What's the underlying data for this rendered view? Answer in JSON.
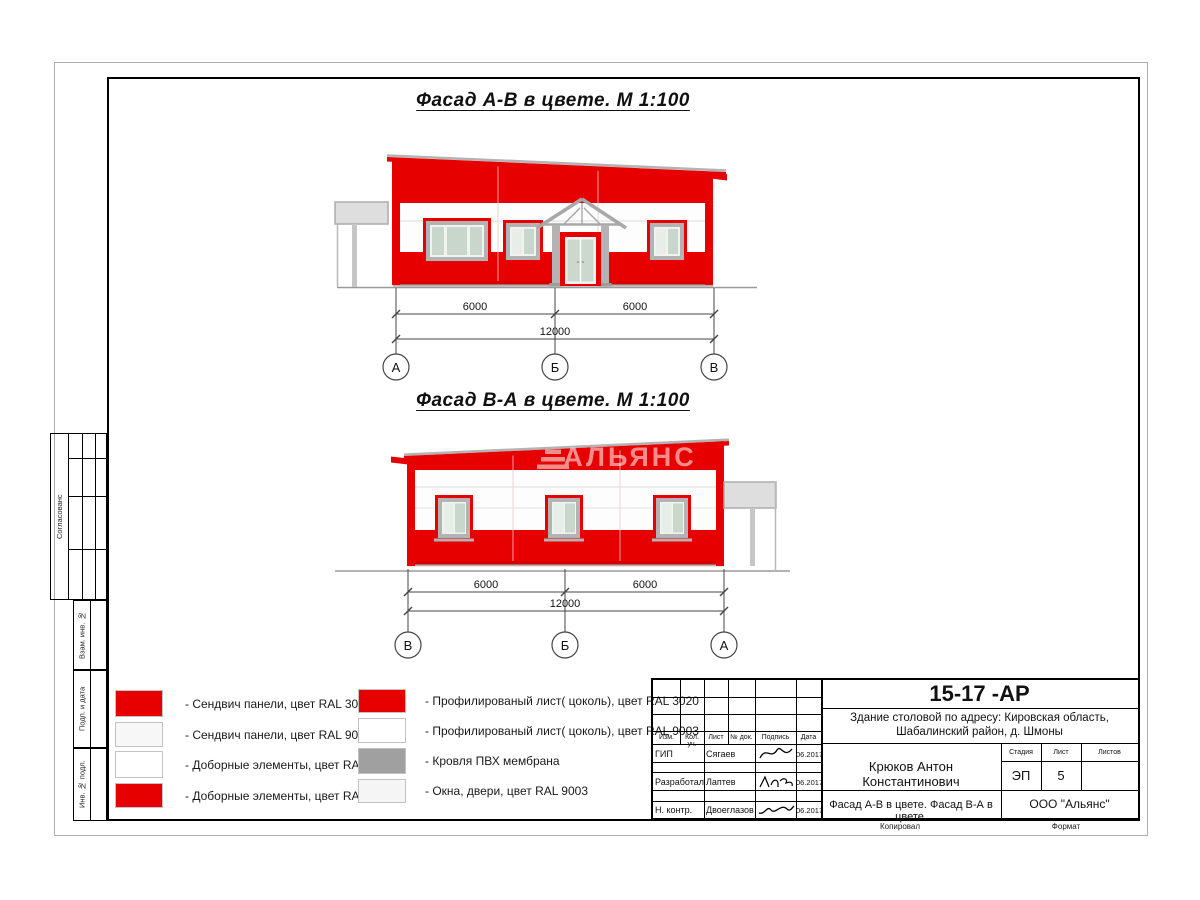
{
  "colors": {
    "red": "#e60000",
    "ral9003": "#f7f7f7",
    "white": "#ffffff",
    "roof_gray": "#a0a0a0",
    "light": "#f5f5f5"
  },
  "facade1": {
    "title": "Фасад А-В в цвете.  М 1:100",
    "dim_left": "6000",
    "dim_right": "6000",
    "dim_total": "12000",
    "axis_left": "А",
    "axis_mid": "Б",
    "axis_right": "В"
  },
  "facade2": {
    "title": "Фасад В-А в цвете.  М 1:100",
    "dim_left": "6000",
    "dim_right": "6000",
    "dim_total": "12000",
    "axis_left": "В",
    "axis_mid": "Б",
    "axis_right": "А",
    "watermark": "АЛЬЯНС"
  },
  "legend": {
    "left": [
      {
        "color": "#e60000",
        "label": "- Сендвич панели, цвет RAL 3020"
      },
      {
        "color": "#f7f7f7",
        "label": "- Сендвич панели, цвет RAL 9003"
      },
      {
        "color": "#ffffff",
        "label": "- Доборные элементы, цвет RAL 9003"
      },
      {
        "color": "#e60000",
        "label": "- Доборные элементы, цвет RAL 3020"
      }
    ],
    "right": [
      {
        "color": "#e60000",
        "label": "- Профилированый лист( цоколь), цвет RAL 3020"
      },
      {
        "color": "#ffffff",
        "label": "- Профилированый лист( цоколь), цвет RAL 9003"
      },
      {
        "color": "#a0a0a0",
        "label": "- Кровля ПВХ мембрана"
      },
      {
        "color": "#f5f5f5",
        "label": "- Окна, двери, цвет RAL 9003"
      }
    ]
  },
  "titleblock": {
    "doc_number": "15-17 -АР",
    "project_line1": "Здание столовой по адресу: Кировская область,",
    "project_line2": "Шабалинский район, д. Шмоны",
    "architect": "Крюков Антон Константинович",
    "sheet_name": "Фасад А-В в цвете. Фасад В-А в цвете.",
    "company": "ООО \"Альянс\"",
    "col_izm": "Изм.",
    "col_kol": "Кол. уч.",
    "col_list": "Лист",
    "col_doc": "№ док.",
    "col_sign": "Подпись",
    "col_date": "Дата",
    "stage_label": "Стадия",
    "sheet_label": "Лист",
    "sheets_label": "Листов",
    "stage": "ЭП",
    "sheet_number": "5",
    "rows": [
      {
        "role": "ГИП",
        "name": "Сягаев",
        "date": "06.2017"
      },
      {
        "role": "Разработал",
        "name": "Лаптев",
        "date": "06.2017"
      },
      {
        "role": "Н. контр.",
        "name": "Двоеглазов",
        "date": "06.2017"
      }
    ],
    "copied_label": "Копировал",
    "format_label": "Формат"
  },
  "margin": {
    "approved": "Согласованс",
    "vzam": "Взам. инв. №",
    "podp": "Подп. и дата",
    "inv": "Инв. № подл."
  }
}
